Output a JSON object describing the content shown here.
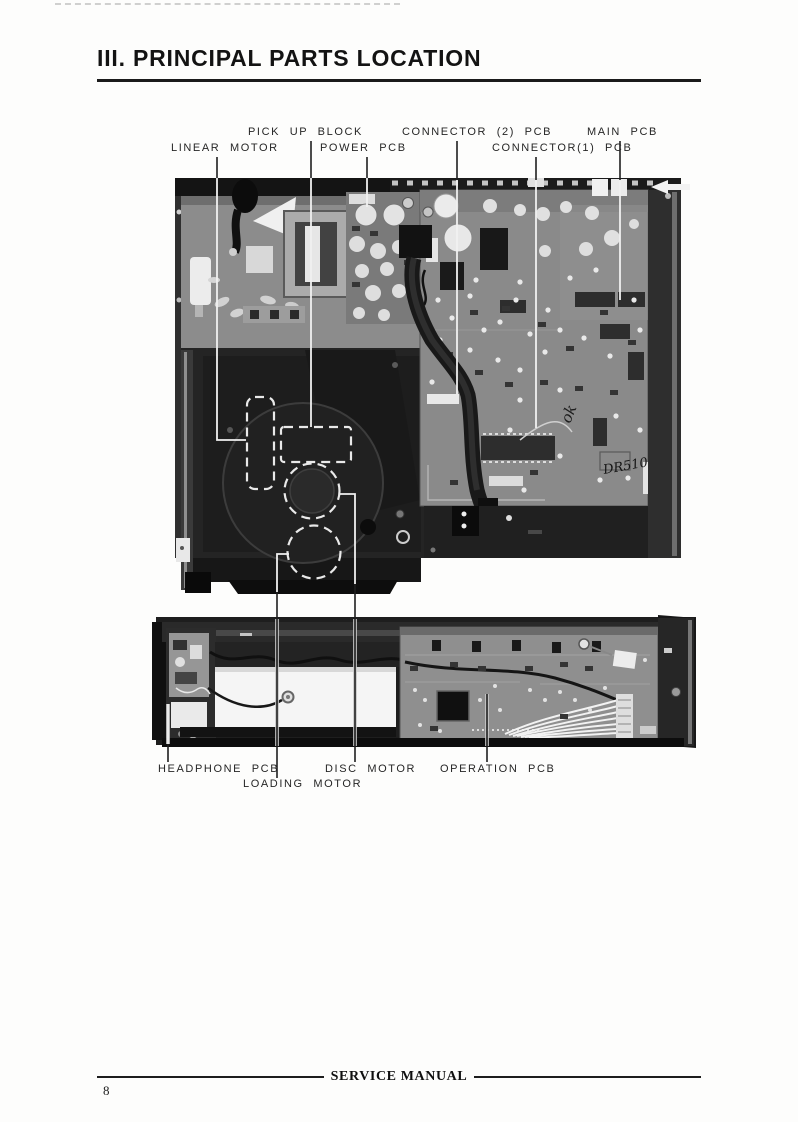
{
  "page": {
    "title": "III. PRINCIPAL PARTS LOCATION",
    "footer_text": "SERVICE MANUAL",
    "page_number": "8"
  },
  "labels": {
    "top": [
      {
        "id": "pick-up-block",
        "text": "PICK UP BLOCK"
      },
      {
        "id": "connector2-pcb",
        "text": "CONNECTOR (2) PCB"
      },
      {
        "id": "main-pcb",
        "text": "MAIN PCB"
      },
      {
        "id": "linear-motor",
        "text": "LINEAR MOTOR"
      },
      {
        "id": "power-pcb",
        "text": "POWER PCB"
      },
      {
        "id": "connector1-pcb",
        "text": "CONNECTOR(1) PCB"
      }
    ],
    "bottom": [
      {
        "id": "headphone-pcb",
        "text": "HEADPHONE PCB"
      },
      {
        "id": "disc-motor",
        "text": "DISC MOTOR"
      },
      {
        "id": "operation-pcb",
        "text": "OPERATION PCB"
      },
      {
        "id": "loading-motor",
        "text": "LOADING MOTOR"
      }
    ]
  },
  "photo_annotations": {
    "handwriting_ok": "ok",
    "handwriting_model": "DR5100"
  }
}
